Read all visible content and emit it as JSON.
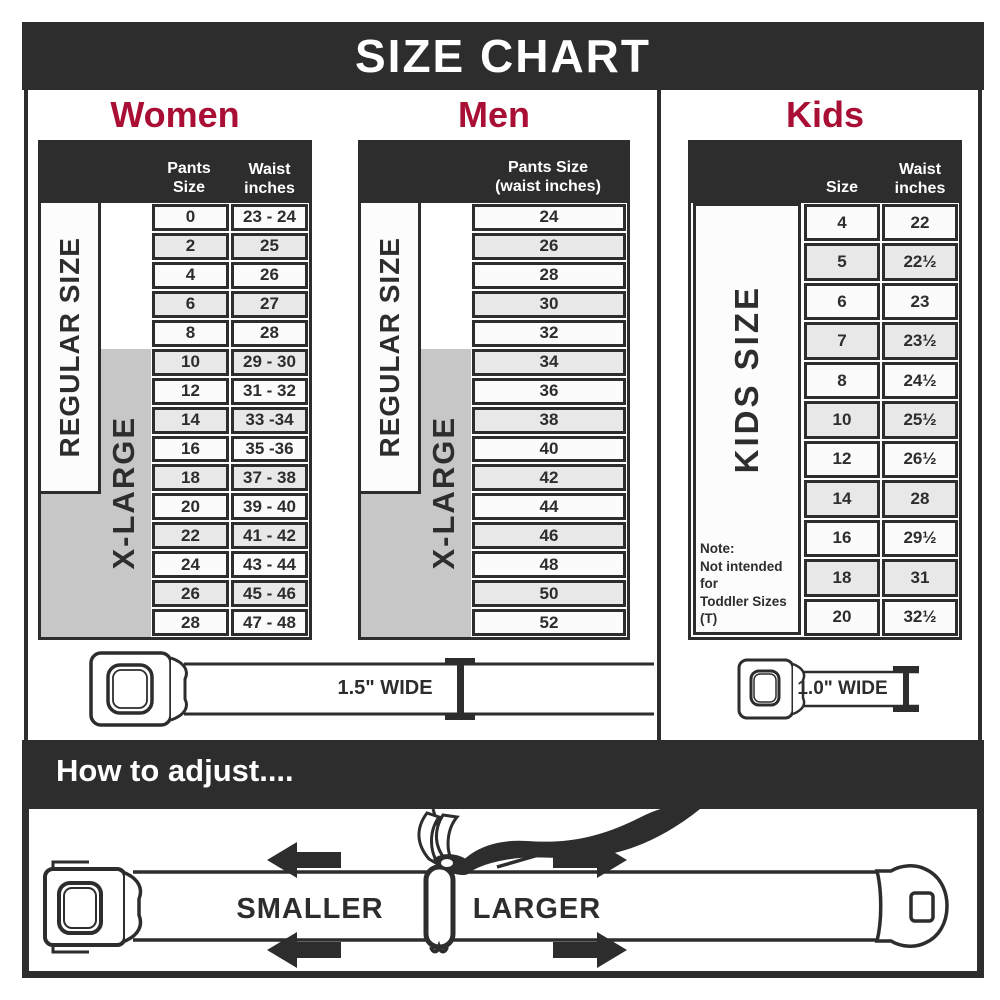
{
  "banner": {
    "title": "SIZE CHART"
  },
  "sections": {
    "women": {
      "title": "Women",
      "header": {
        "col_pants": "Pants Size",
        "col_waist_l1": "Waist",
        "col_waist_l2": "inches"
      },
      "labels": {
        "regular": "REGULAR SIZE",
        "xlarge": "X-LARGE"
      },
      "rows": [
        {
          "size": "0",
          "waist": "23 - 24"
        },
        {
          "size": "2",
          "waist": "25"
        },
        {
          "size": "4",
          "waist": "26"
        },
        {
          "size": "6",
          "waist": "27"
        },
        {
          "size": "8",
          "waist": "28"
        },
        {
          "size": "10",
          "waist": "29 - 30"
        },
        {
          "size": "12",
          "waist": "31 - 32"
        },
        {
          "size": "14",
          "waist": "33 -34"
        },
        {
          "size": "16",
          "waist": "35 -36"
        },
        {
          "size": "18",
          "waist": "37 - 38"
        },
        {
          "size": "20",
          "waist": "39 - 40"
        },
        {
          "size": "22",
          "waist": "41 - 42"
        },
        {
          "size": "24",
          "waist": "43 - 44"
        },
        {
          "size": "26",
          "waist": "45 - 46"
        },
        {
          "size": "28",
          "waist": "47 - 48"
        }
      ]
    },
    "men": {
      "title": "Men",
      "header": {
        "l1": "Pants Size",
        "l2": "(waist inches)"
      },
      "labels": {
        "regular": "REGULAR SIZE",
        "xlarge": "X-LARGE"
      },
      "rows": [
        "24",
        "26",
        "28",
        "30",
        "32",
        "34",
        "36",
        "38",
        "40",
        "42",
        "44",
        "46",
        "48",
        "50",
        "52"
      ]
    },
    "kids": {
      "title": "Kids",
      "header": {
        "col_size": "Size",
        "col_waist_l1": "Waist",
        "col_waist_l2": "inches"
      },
      "labels": {
        "side": "KIDS SIZE"
      },
      "note": {
        "l1": "Note:",
        "l2": "Not intended for",
        "l3": "Toddler Sizes (T)"
      },
      "rows": [
        {
          "size": "4",
          "waist": "22"
        },
        {
          "size": "5",
          "waist": "22½"
        },
        {
          "size": "6",
          "waist": "23"
        },
        {
          "size": "7",
          "waist": "23½"
        },
        {
          "size": "8",
          "waist": "24½"
        },
        {
          "size": "10",
          "waist": "25½"
        },
        {
          "size": "12",
          "waist": "26½"
        },
        {
          "size": "14",
          "waist": "28"
        },
        {
          "size": "16",
          "waist": "29½"
        },
        {
          "size": "18",
          "waist": "31"
        },
        {
          "size": "20",
          "waist": "32½"
        }
      ]
    }
  },
  "belts": {
    "adult": "1.5\" WIDE",
    "kids": "1.0\" WIDE"
  },
  "how_to": {
    "title": "How to adjust....",
    "smaller": "SMALLER",
    "larger": "LARGER"
  },
  "colors": {
    "dark": "#2d2d2d",
    "accent": "#a90e35",
    "grey_box": "#c7c7c7"
  }
}
